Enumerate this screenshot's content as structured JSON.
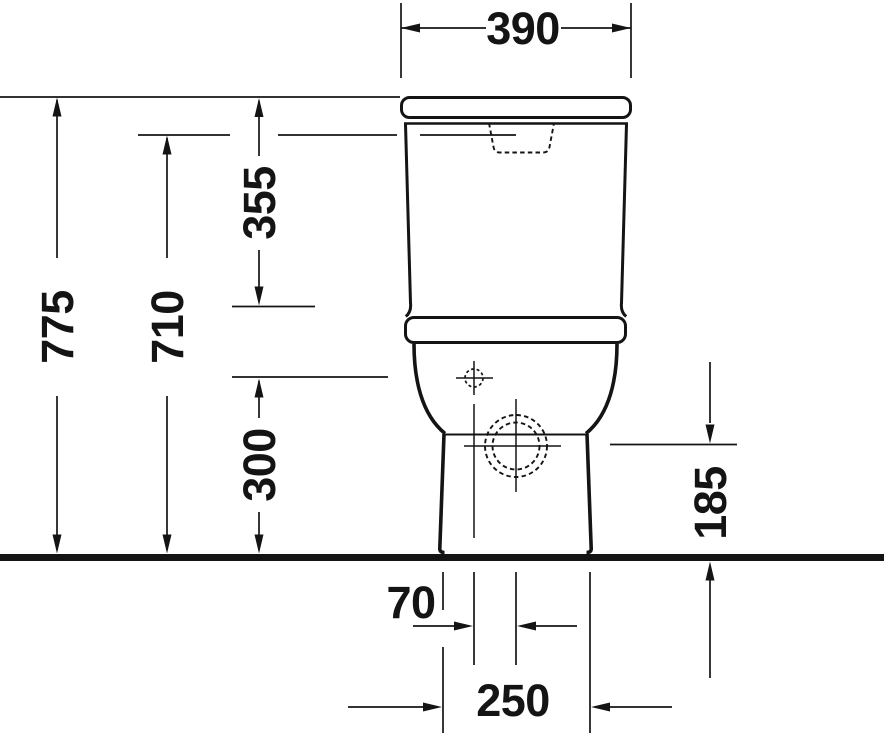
{
  "colors": {
    "ink": "#141414",
    "background": "#ffffff"
  },
  "drawing": {
    "type": "technical-elevation-front-view",
    "dimension_labels": {
      "top_width": "390",
      "overall_height": "775",
      "height_to_tank_top": "710",
      "tank_height": "355",
      "inlet_center_height": "300",
      "outlet_center_height": "185",
      "center_offset": "70",
      "base_width": "250"
    }
  }
}
